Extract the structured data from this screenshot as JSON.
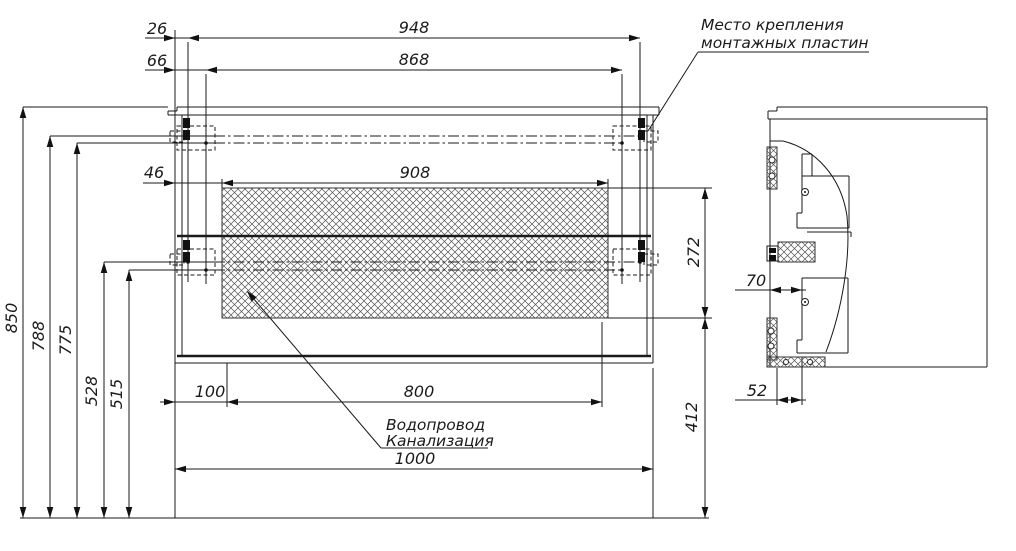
{
  "figure": {
    "type": "technical-installation-drawing",
    "views": [
      "front",
      "side"
    ],
    "units": "mm"
  },
  "annotations": {
    "mounting_plates_line1": "Место крепления",
    "mounting_plates_line2": "монтажных пластин",
    "plumbing_line1": "Водопровод",
    "plumbing_line2": "Канализация"
  },
  "dimension_values": {
    "front_view": [
      "26",
      "66",
      "948",
      "868",
      "46",
      "908",
      "272",
      "850",
      "788",
      "775",
      "528",
      "515",
      "100",
      "800",
      "412",
      "1000"
    ],
    "side_view": [
      "70",
      "52"
    ]
  },
  "drawing": {
    "width": 1016,
    "height": 551,
    "line_color": "#1a1a1a",
    "thin_lines": [
      [
        177,
        107,
        659,
        107
      ],
      [
        177,
        107,
        177,
        111
      ],
      [
        168,
        111,
        177,
        111
      ],
      [
        168,
        111,
        168,
        115
      ],
      [
        168,
        115,
        659,
        115
      ],
      [
        659,
        107,
        659,
        115
      ],
      [
        175,
        115,
        175,
        363
      ],
      [
        182,
        115,
        182,
        356
      ],
      [
        647,
        115,
        647,
        356
      ],
      [
        653,
        115,
        653,
        363
      ],
      [
        175,
        363,
        653,
        363
      ],
      [
        777,
        107,
        987,
        107
      ],
      [
        777,
        107,
        777,
        111
      ],
      [
        768,
        111,
        777,
        111
      ],
      [
        768,
        111,
        768,
        119
      ],
      [
        768,
        119,
        987,
        119
      ],
      [
        987,
        107,
        987,
        367
      ],
      [
        770,
        119,
        770,
        367
      ],
      [
        770,
        367,
        987,
        367
      ],
      [
        770,
        141,
        783,
        141
      ],
      [
        812,
        154,
        802,
        154
      ],
      [
        802,
        154,
        802,
        176
      ],
      [
        812,
        154,
        812,
        176
      ],
      [
        802,
        176,
        849,
        176
      ],
      [
        802,
        176,
        802,
        213
      ],
      [
        802,
        213,
        797,
        213
      ],
      [
        797,
        213,
        797,
        228
      ],
      [
        797,
        228,
        849,
        228
      ],
      [
        849,
        176,
        849,
        228
      ],
      [
        807,
        232,
        851,
        232
      ],
      [
        851,
        232,
        851,
        237
      ],
      [
        802,
        278,
        848,
        278
      ],
      [
        802,
        278,
        802,
        340
      ],
      [
        802,
        340,
        797,
        340
      ],
      [
        797,
        340,
        797,
        353
      ],
      [
        797,
        353,
        848,
        353
      ],
      [
        848,
        278,
        848,
        353
      ],
      [
        175,
        30,
        175,
        115
      ],
      [
        175,
        363,
        175,
        518
      ],
      [
        145,
        38,
        640,
        38
      ],
      [
        145,
        70,
        622,
        70
      ],
      [
        143,
        183,
        608,
        183
      ],
      [
        222,
        179,
        222,
        188
      ],
      [
        608,
        179,
        608,
        188
      ],
      [
        608,
        188,
        712,
        188
      ],
      [
        608,
        318,
        712,
        318
      ],
      [
        160,
        402,
        602,
        402
      ],
      [
        227,
        363,
        227,
        407
      ],
      [
        602,
        322,
        602,
        407
      ],
      [
        175,
        469,
        653,
        469
      ],
      [
        653,
        368,
        653,
        518
      ],
      [
        23,
        107,
        23,
        518
      ],
      [
        50,
        136,
        50,
        518
      ],
      [
        77,
        143,
        77,
        518
      ],
      [
        104,
        262,
        104,
        518
      ],
      [
        129,
        270,
        129,
        518
      ],
      [
        23,
        107,
        168,
        107
      ],
      [
        50,
        136,
        214,
        136
      ],
      [
        77,
        143,
        214,
        143
      ],
      [
        104,
        262,
        214,
        262
      ],
      [
        129,
        270,
        214,
        270
      ],
      [
        705,
        188,
        705,
        318
      ],
      [
        705,
        318,
        705,
        518
      ],
      [
        188,
        42,
        188,
        282
      ],
      [
        206,
        74,
        206,
        284
      ],
      [
        640,
        42,
        640,
        282
      ],
      [
        622,
        74,
        622,
        284
      ],
      [
        735,
        290,
        806,
        290
      ],
      [
        735,
        400,
        806,
        400
      ],
      [
        777,
        368,
        777,
        405
      ],
      [
        802,
        357,
        802,
        405
      ],
      [
        648,
        131,
        698,
        52
      ],
      [
        698,
        52,
        869,
        52
      ],
      [
        247,
        291,
        381,
        448
      ],
      [
        381,
        448,
        488,
        448
      ],
      [
        20,
        518,
        709,
        518
      ]
    ],
    "bold_lines": [
      [
        177,
        236,
        651,
        236
      ],
      [
        177,
        356,
        651,
        356
      ]
    ],
    "dashdot_lines": [
      [
        214,
        136,
        640,
        136
      ],
      [
        214,
        143,
        622,
        143
      ],
      [
        214,
        262,
        640,
        262
      ],
      [
        214,
        270,
        622,
        270
      ]
    ],
    "dashed_rects": [
      [
        177,
        126,
        38,
        24
      ],
      [
        170,
        131,
        14,
        11
      ],
      [
        177,
        249,
        38,
        26
      ],
      [
        170,
        254,
        14,
        11
      ],
      [
        613,
        126,
        38,
        24
      ],
      [
        644,
        131,
        14,
        11
      ],
      [
        613,
        249,
        38,
        26
      ],
      [
        644,
        254,
        14,
        11
      ]
    ],
    "solid_rects": [
      [
        183,
        118,
        7,
        10
      ],
      [
        183,
        130,
        7,
        10
      ],
      [
        183,
        240,
        7,
        10
      ],
      [
        183,
        252,
        7,
        10
      ],
      [
        638,
        118,
        7,
        10
      ],
      [
        638,
        130,
        7,
        10
      ],
      [
        638,
        240,
        7,
        10
      ],
      [
        638,
        252,
        7,
        10
      ],
      [
        769,
        248,
        7,
        5
      ],
      [
        769,
        255,
        7,
        6
      ]
    ],
    "outline_rects": [
      [
        767,
        246,
        11,
        15
      ]
    ],
    "hatch_rects": [
      [
        222,
        188,
        386,
        130
      ],
      [
        767,
        147,
        10,
        42
      ],
      [
        767,
        318,
        10,
        42
      ],
      [
        778,
        242,
        37,
        20
      ],
      [
        767,
        357,
        58,
        10
      ]
    ],
    "curves": [
      "M783,141 C815,149 841,176 847,216 C851,258 842,310 826,352"
    ],
    "circles": [
      [
        772,
        160,
        3
      ],
      [
        772,
        176,
        3
      ],
      [
        771,
        331,
        3
      ],
      [
        771,
        346,
        3
      ],
      [
        805,
        192,
        3.5
      ],
      [
        805,
        302,
        3.5
      ],
      [
        786,
        362,
        2.5
      ],
      [
        810,
        362,
        2.5
      ]
    ],
    "dots": [
      [
        188,
        136,
        1.8
      ],
      [
        206,
        143,
        1.8
      ],
      [
        188,
        262,
        1.8
      ],
      [
        206,
        270,
        1.8
      ],
      [
        640,
        136,
        1.8
      ],
      [
        622,
        143,
        1.8
      ],
      [
        640,
        262,
        1.8
      ],
      [
        622,
        270,
        1.8
      ],
      [
        805,
        192,
        1
      ],
      [
        805,
        302,
        1
      ]
    ],
    "arrows": [
      {
        "x": 175,
        "y": 38,
        "dir": "right"
      },
      {
        "x": 188,
        "y": 38,
        "dir": "left"
      },
      {
        "x": 640,
        "y": 38,
        "dir": "right"
      },
      {
        "x": 175,
        "y": 70,
        "dir": "right"
      },
      {
        "x": 206,
        "y": 70,
        "dir": "left"
      },
      {
        "x": 622,
        "y": 70,
        "dir": "right"
      },
      {
        "x": 175,
        "y": 183,
        "dir": "right"
      },
      {
        "x": 222,
        "y": 183,
        "dir": "left"
      },
      {
        "x": 608,
        "y": 183,
        "dir": "right"
      },
      {
        "x": 175,
        "y": 402,
        "dir": "right"
      },
      {
        "x": 227,
        "y": 402,
        "dir": "left"
      },
      {
        "x": 602,
        "y": 402,
        "dir": "right"
      },
      {
        "x": 175,
        "y": 469,
        "dir": "left"
      },
      {
        "x": 653,
        "y": 469,
        "dir": "right"
      },
      {
        "x": 23,
        "y": 107,
        "dir": "up"
      },
      {
        "x": 23,
        "y": 518,
        "dir": "down"
      },
      {
        "x": 50,
        "y": 136,
        "dir": "up"
      },
      {
        "x": 50,
        "y": 518,
        "dir": "down"
      },
      {
        "x": 77,
        "y": 143,
        "dir": "up"
      },
      {
        "x": 77,
        "y": 518,
        "dir": "down"
      },
      {
        "x": 104,
        "y": 262,
        "dir": "up"
      },
      {
        "x": 104,
        "y": 518,
        "dir": "down"
      },
      {
        "x": 129,
        "y": 270,
        "dir": "up"
      },
      {
        "x": 129,
        "y": 518,
        "dir": "down"
      },
      {
        "x": 705,
        "y": 188,
        "dir": "up"
      },
      {
        "x": 705,
        "y": 318,
        "dir": "down"
      },
      {
        "x": 705,
        "y": 318,
        "dir": "up"
      },
      {
        "x": 705,
        "y": 518,
        "dir": "down"
      },
      {
        "x": 770,
        "y": 290,
        "dir": "left"
      },
      {
        "x": 802,
        "y": 290,
        "dir": "right"
      },
      {
        "x": 777,
        "y": 400,
        "dir": "left"
      },
      {
        "x": 802,
        "y": 400,
        "dir": "right"
      },
      {
        "x": 247,
        "y": 291,
        "angle": -130.5
      }
    ],
    "labels": [
      {
        "text": "26",
        "x": 157,
        "y": 34,
        "rot": 0,
        "anchor": "middle",
        "size": 16,
        "name": "dim-label-26"
      },
      {
        "text": "948",
        "x": 414,
        "y": 33,
        "rot": 0,
        "anchor": "middle",
        "size": 16,
        "name": "dim-label-948"
      },
      {
        "text": "66",
        "x": 157,
        "y": 66,
        "rot": 0,
        "anchor": "middle",
        "size": 16,
        "name": "dim-label-66"
      },
      {
        "text": "868",
        "x": 414,
        "y": 65,
        "rot": 0,
        "anchor": "middle",
        "size": 16,
        "name": "dim-label-868"
      },
      {
        "text": "46",
        "x": 154,
        "y": 178,
        "rot": 0,
        "anchor": "middle",
        "size": 16,
        "name": "dim-label-46"
      },
      {
        "text": "908",
        "x": 415,
        "y": 178,
        "rot": 0,
        "anchor": "middle",
        "size": 16,
        "name": "dim-label-908"
      },
      {
        "text": "850",
        "x": 17,
        "y": 318,
        "rot": -90,
        "anchor": "middle",
        "size": 16,
        "name": "dim-label-850"
      },
      {
        "text": "788",
        "x": 44,
        "y": 336,
        "rot": -90,
        "anchor": "middle",
        "size": 16,
        "name": "dim-label-788"
      },
      {
        "text": "775",
        "x": 71,
        "y": 340,
        "rot": -90,
        "anchor": "middle",
        "size": 16,
        "name": "dim-label-775"
      },
      {
        "text": "528",
        "x": 97,
        "y": 391,
        "rot": -90,
        "anchor": "middle",
        "size": 16,
        "name": "dim-label-528"
      },
      {
        "text": "515",
        "x": 122,
        "y": 394,
        "rot": -90,
        "anchor": "middle",
        "size": 16,
        "name": "dim-label-515"
      },
      {
        "text": "272",
        "x": 699,
        "y": 252,
        "rot": -90,
        "anchor": "middle",
        "size": 16,
        "name": "dim-label-272"
      },
      {
        "text": "412",
        "x": 697,
        "y": 417,
        "rot": -90,
        "anchor": "middle",
        "size": 16,
        "name": "dim-label-412"
      },
      {
        "text": "100",
        "x": 210,
        "y": 397,
        "rot": 0,
        "anchor": "middle",
        "size": 16,
        "name": "dim-label-100"
      },
      {
        "text": "800",
        "x": 419,
        "y": 397,
        "rot": 0,
        "anchor": "middle",
        "size": 16,
        "name": "dim-label-800"
      },
      {
        "text": "1000",
        "x": 415,
        "y": 464,
        "rot": 0,
        "anchor": "middle",
        "size": 16,
        "name": "dim-label-1000"
      },
      {
        "text": "70",
        "x": 756,
        "y": 286,
        "rot": 0,
        "anchor": "middle",
        "size": 16,
        "name": "dim-label-70"
      },
      {
        "text": "52",
        "x": 757,
        "y": 396,
        "rot": 0,
        "anchor": "middle",
        "size": 16,
        "name": "dim-label-52"
      },
      {
        "text": "Место крепления",
        "x": 701,
        "y": 30,
        "rot": 0,
        "anchor": "start",
        "size": 15.5,
        "name": "note-mounting-plates-line1"
      },
      {
        "text": "монтажных пластин",
        "x": 701,
        "y": 48,
        "rot": 0,
        "anchor": "start",
        "size": 15.5,
        "name": "note-mounting-plates-line2"
      },
      {
        "text": "Водопровод",
        "x": 386,
        "y": 430,
        "rot": 0,
        "anchor": "start",
        "size": 15.5,
        "name": "note-plumbing-line1"
      },
      {
        "text": "Канализация",
        "x": 386,
        "y": 446,
        "rot": 0,
        "anchor": "start",
        "size": 15.5,
        "name": "note-plumbing-line2"
      }
    ]
  }
}
